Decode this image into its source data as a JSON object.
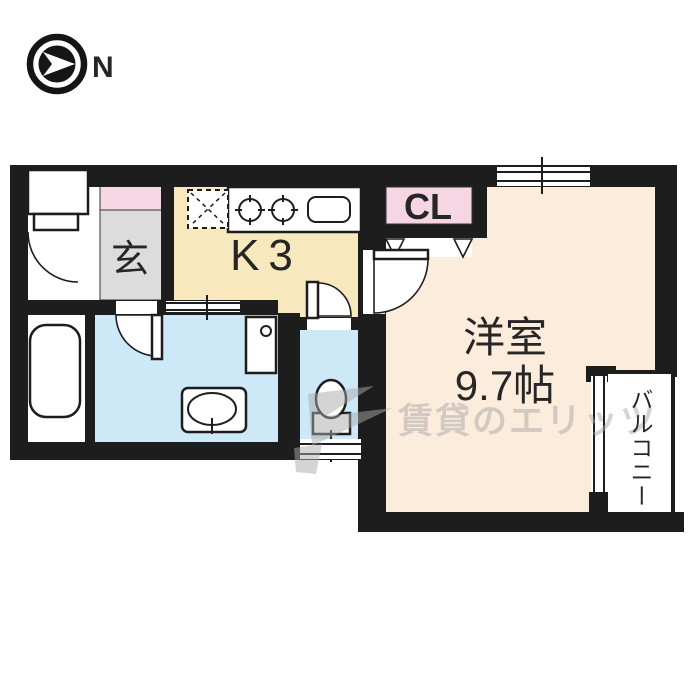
{
  "compass": {
    "north_label": "N"
  },
  "labels": {
    "entrance": "玄",
    "kitchen": "K3",
    "closet": "CL",
    "western_room": "洋室",
    "western_room_size": "9.7帖",
    "balcony": "バルコニー"
  },
  "watermark": {
    "text": "賃貸のエリッツ"
  },
  "colors": {
    "wall": "#1d1d1d",
    "kitchen_floor": "#f7e9bd",
    "entrance_floor": "#dcdcdc",
    "closet_pink": "#f7d6e4",
    "room_cream": "#fcecdc",
    "wet_area_blue": "#cde8f6",
    "watermark_gray": "#a9a9a9"
  }
}
